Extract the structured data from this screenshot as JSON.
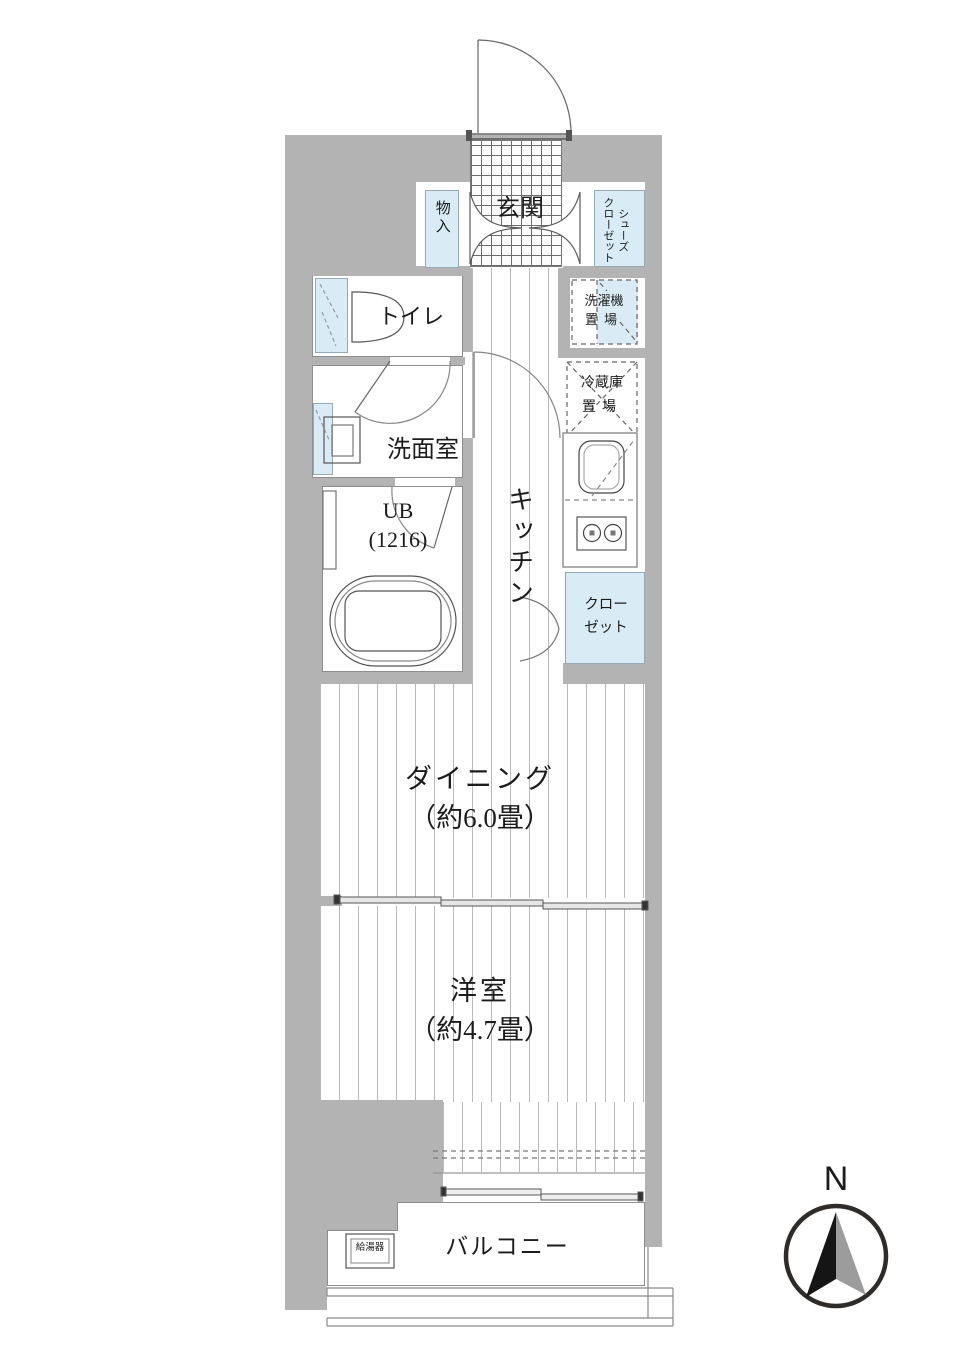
{
  "plan": {
    "entrance": {
      "genkan": "玄関",
      "storage": "物入",
      "shoes_closet_col1": "シューズ",
      "shoes_closet_col2": "クローゼット"
    },
    "sanitary": {
      "toilet": "トイレ",
      "washroom": "洗面室",
      "bath_line1": "UB",
      "bath_line2": "(1216)"
    },
    "kitchen": {
      "name": "キッチン",
      "washer_line1": "洗濯機",
      "washer_line2": "置場",
      "fridge_line1": "冷蔵庫",
      "fridge_line2": "置場",
      "closet_line1": "クロー",
      "closet_line2": "ゼット"
    },
    "living": {
      "dining_name": "ダイニング",
      "dining_size": "（約6.0畳）",
      "bedroom_name": "洋室",
      "bedroom_size": "（約4.7畳）"
    },
    "outdoor": {
      "balcony": "バルコニー",
      "water_heater": "給湯器"
    },
    "compass": {
      "north": "N"
    },
    "colors": {
      "wall_gray": "#b3b3b3",
      "fixture_blue": "#d9ecf6",
      "line_dark": "#555555"
    }
  }
}
